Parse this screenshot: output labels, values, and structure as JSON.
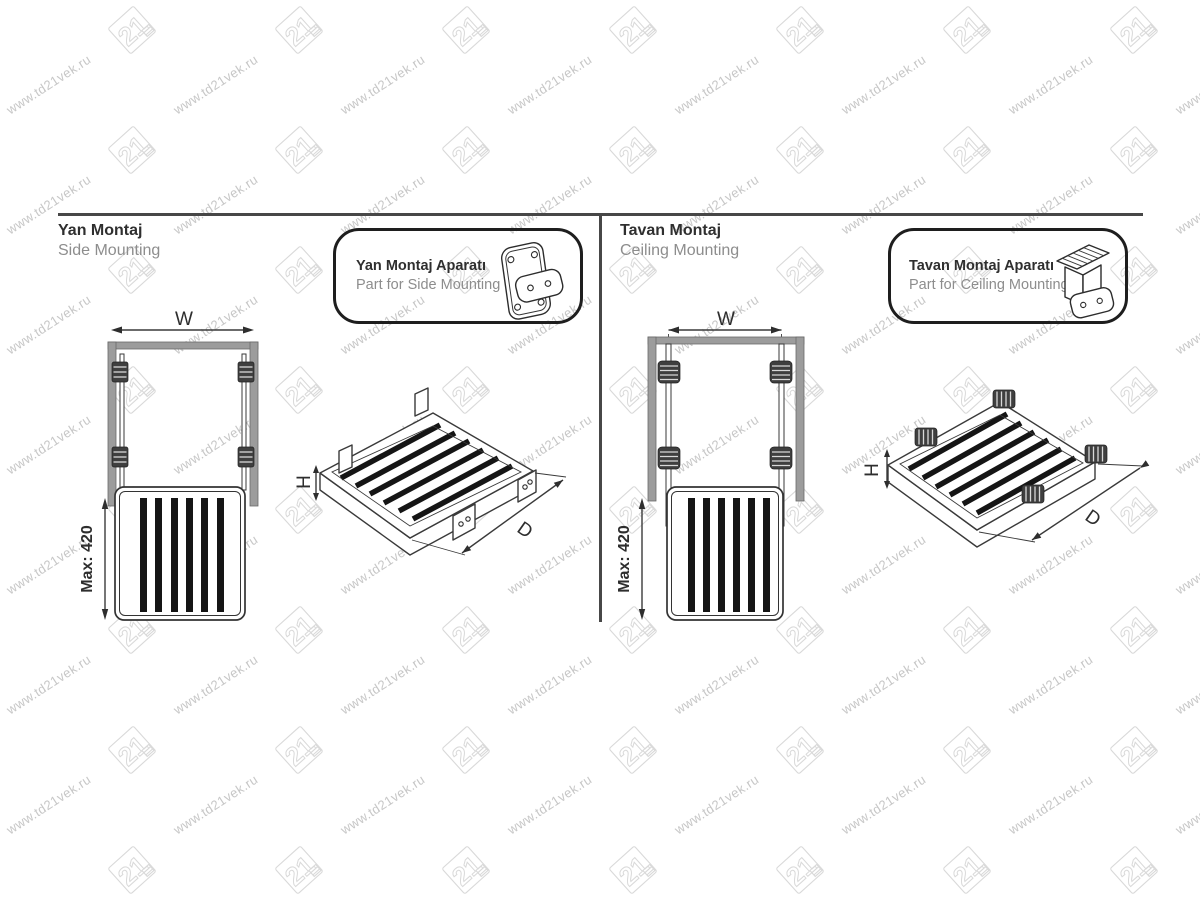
{
  "watermark": {
    "text": "www.td21vek.ru",
    "logo_text": "21",
    "text_color": "#c7c7c7",
    "logo_color": "#d9d9d9"
  },
  "rule_color": "#474747",
  "sections": {
    "side": {
      "title_tr": "Yan Montaj",
      "title_en": "Side Mounting",
      "part_box": {
        "title_tr": "Yan Montaj Aparatı",
        "title_en": "Part for Side Mounting"
      },
      "labels": {
        "width": "W",
        "max_height": "Max: 420",
        "height": "H",
        "depth": "D"
      }
    },
    "ceiling": {
      "title_tr": "Tavan Montaj",
      "title_en": "Ceiling Mounting",
      "part_box": {
        "title_tr": "Tavan Montaj Aparatı",
        "title_en": "Part for Ceiling Mounting"
      },
      "labels": {
        "width": "W",
        "max_height": "Max: 420",
        "height": "H",
        "depth": "D"
      }
    }
  },
  "colors": {
    "line": "#3a3a3a",
    "panel_fill": "#9c9c9c",
    "slat": "#151515",
    "title": "#2f2f2f",
    "subtitle": "#8d8d8d"
  }
}
